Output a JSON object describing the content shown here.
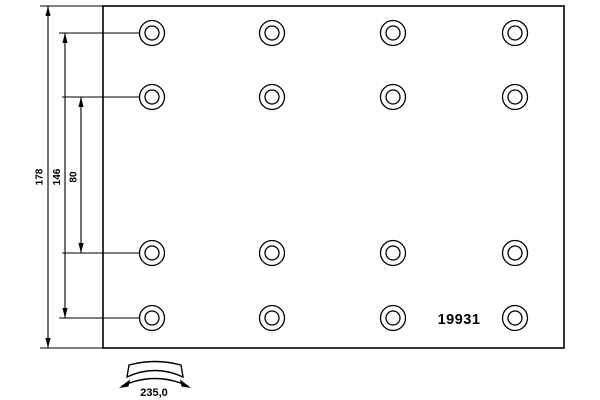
{
  "drawing": {
    "background_color": "#ffffff",
    "line_color": "#000000",
    "part_number": "19931",
    "labels": {
      "total_height": "178",
      "outer_hole_span": "146",
      "inner_hole_span": "80",
      "arc_width": "235,0"
    },
    "plate": {
      "x": 103,
      "y": 6,
      "width": 461,
      "height": 342
    },
    "holes": {
      "columns_x": [
        152,
        272,
        393,
        515
      ],
      "rows_y": [
        33,
        97,
        253,
        318
      ],
      "outer_radius": 12.5,
      "inner_radius": 7
    }
  }
}
